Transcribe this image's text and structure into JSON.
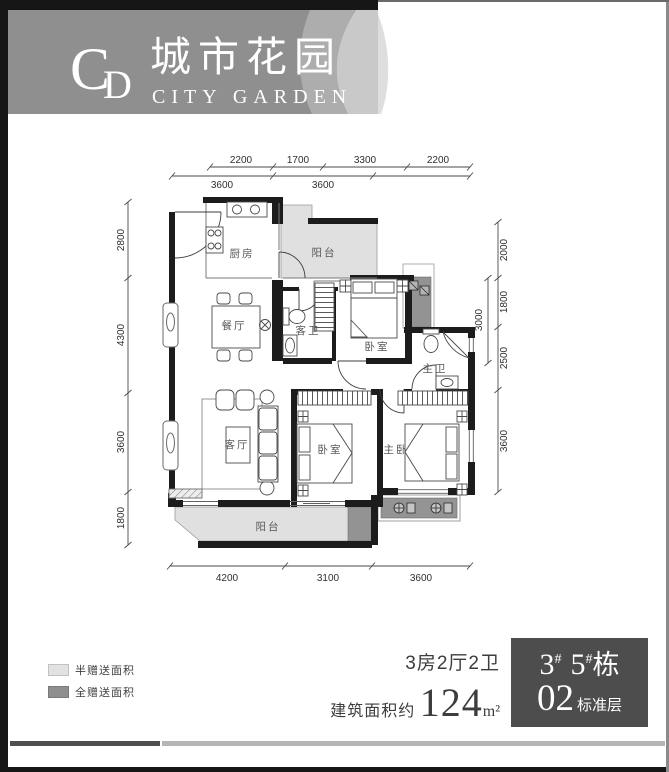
{
  "logo": {
    "monogram_c": "C",
    "monogram_d": "D",
    "name_cn": "城市花园",
    "name_en": "CITY GARDEN"
  },
  "dimensions": {
    "top_row1": [
      "2200",
      "1700",
      "3300",
      "2200"
    ],
    "top_row2": [
      "3600",
      "3600"
    ],
    "left": [
      "2800",
      "4300",
      "3600",
      "1800"
    ],
    "right": [
      "2000",
      "1800",
      "2500",
      "3600"
    ],
    "right_inner": "3000",
    "bottom": [
      "4200",
      "3100",
      "3600"
    ]
  },
  "rooms": {
    "kitchen": "厨房",
    "balcony_top": "阳台",
    "dining": "餐厅",
    "guest_bath": "客卫",
    "bedroom_top": "卧室",
    "master_bath": "主卫",
    "living": "客厅",
    "bedroom_mid": "卧室",
    "master_bedroom": "主卧",
    "balcony_bottom": "阳台"
  },
  "legend": {
    "half": "半赠送面积",
    "full": "全赠送面积"
  },
  "summary": {
    "layout": "3房2厅2卫",
    "area_label": "建筑面积约",
    "area_value": "124",
    "area_unit": "m²"
  },
  "badge": {
    "num1": "3",
    "hash1": "#",
    "num2": "5",
    "hash2": "#",
    "building": "栋",
    "floor_num": "02",
    "floor_label": "标准层"
  },
  "colors": {
    "half_area": "#e0e0e0",
    "full_area": "#939393",
    "wall": "#1c1c1c",
    "banner": "#8f8f8f",
    "banner_swoosh_mid": "#adadad",
    "banner_swoosh_light": "#c9c9c9",
    "badge_bg": "#4d4d4d",
    "footer_dark": "#4f4f4f",
    "footer_light": "#b5b5b5"
  }
}
